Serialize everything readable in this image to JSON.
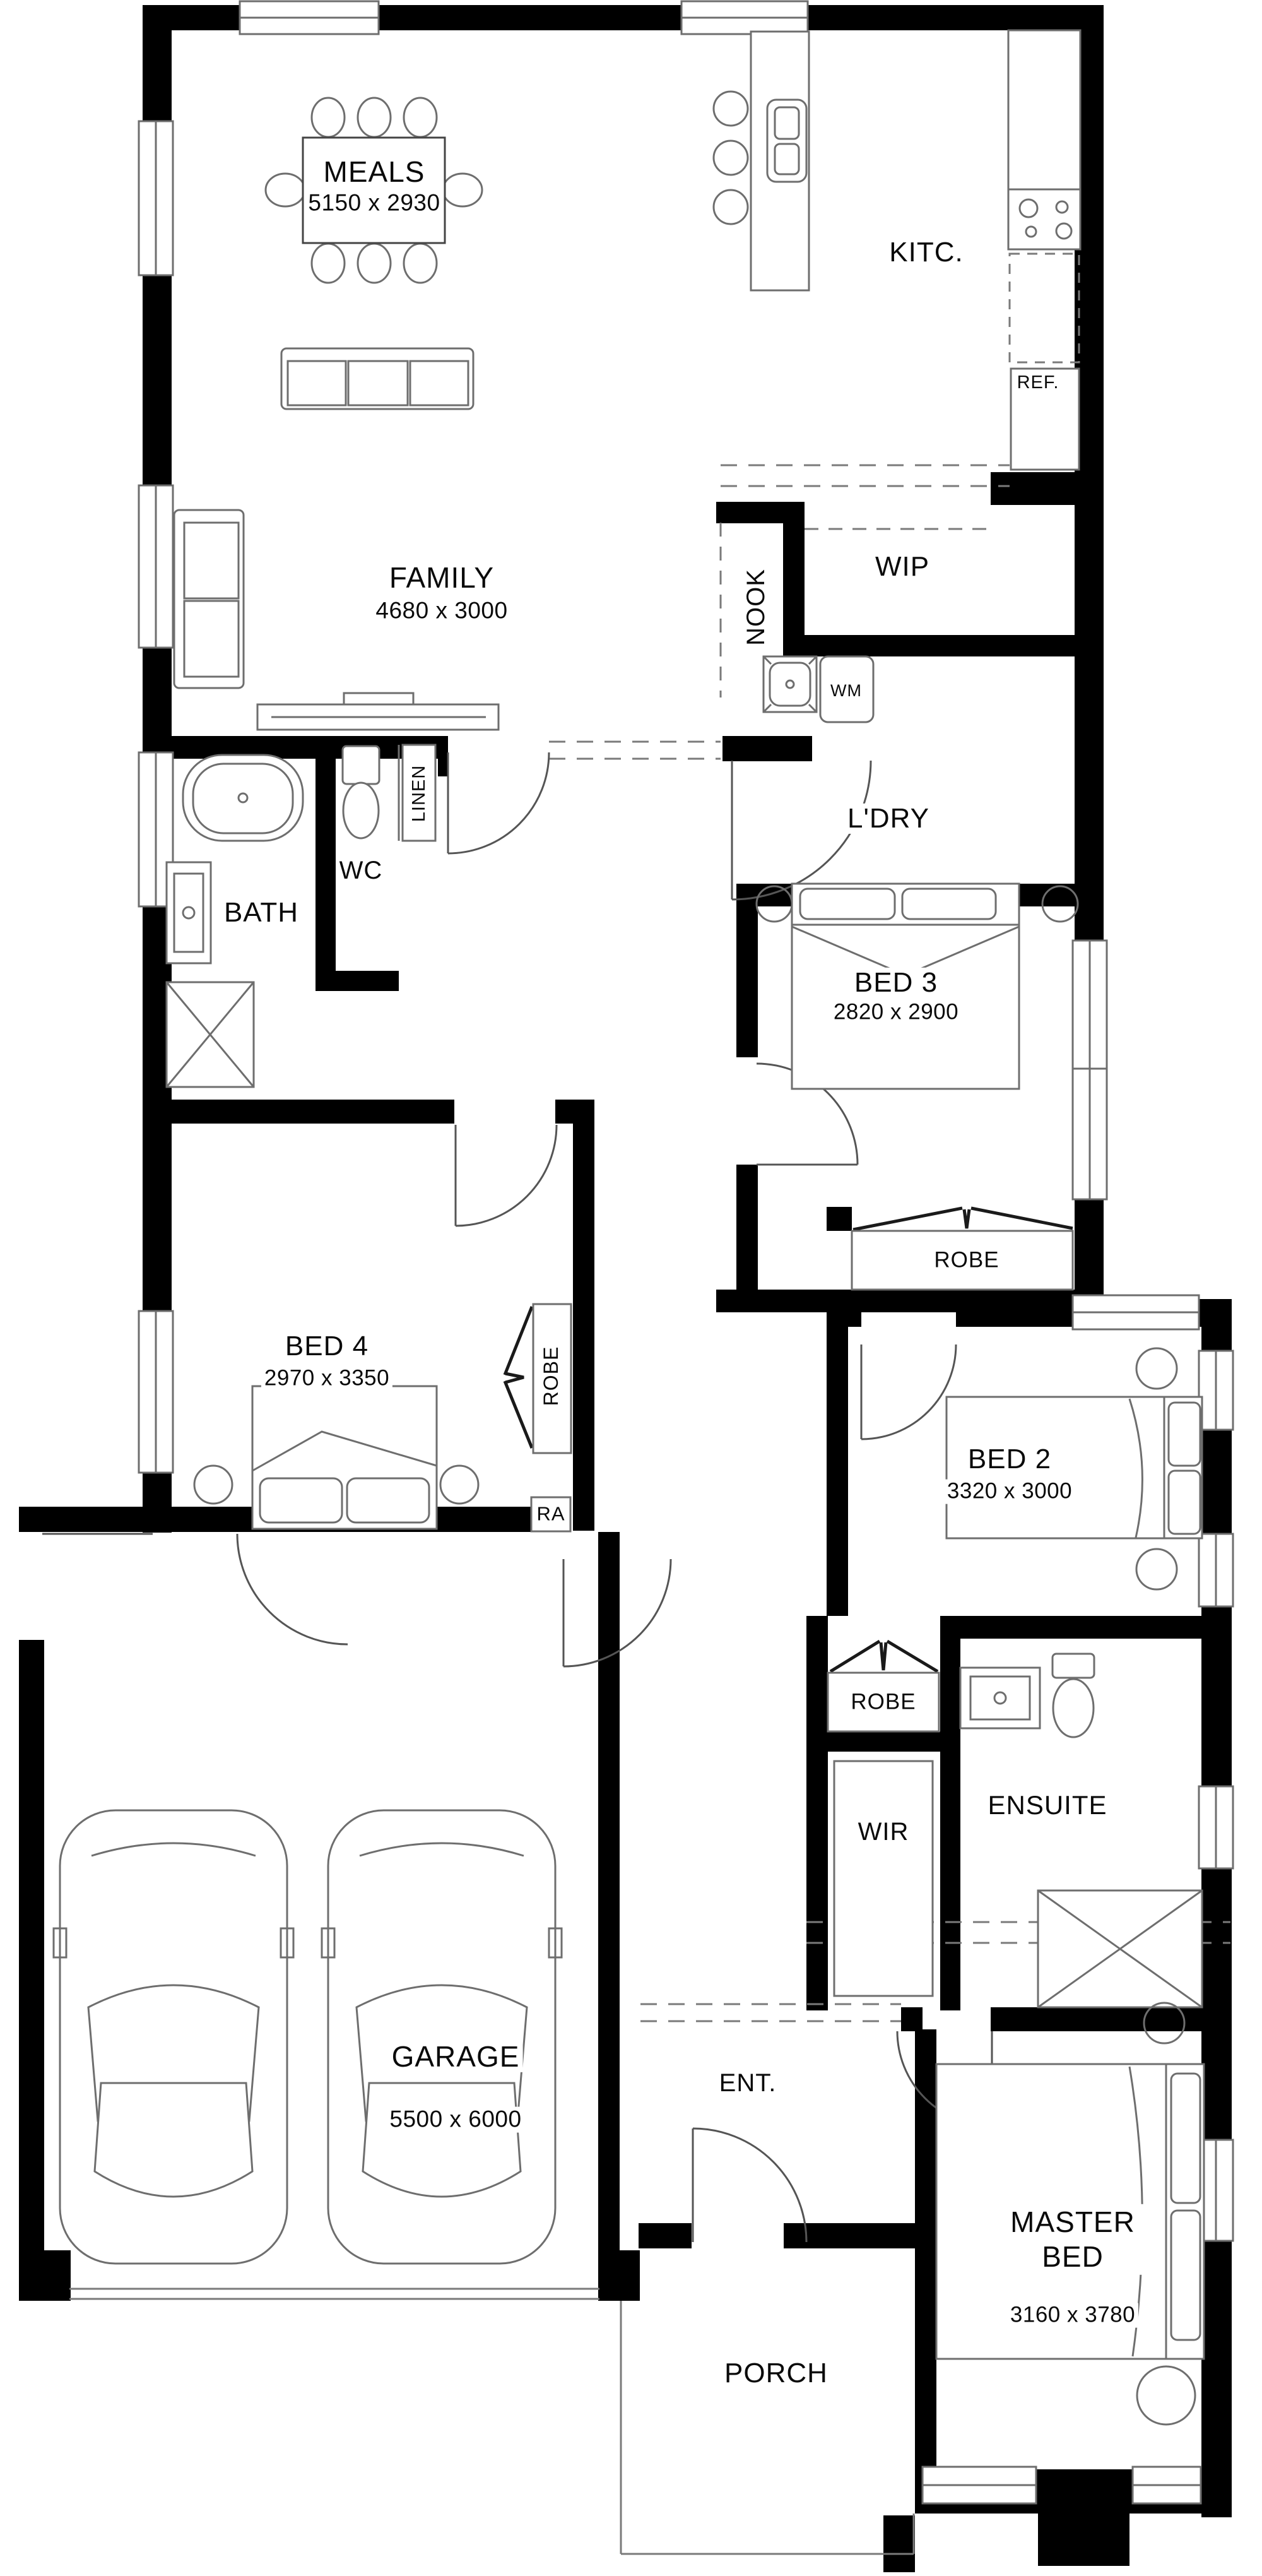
{
  "drawing_type": "residential floor plan",
  "colors": {
    "walls": "#000000",
    "lines": "#6e6e6e",
    "background": "#ffffff",
    "text": "#0a0a0a"
  },
  "rooms": {
    "meals": {
      "name": "MEALS",
      "dims": "5150 x 2930"
    },
    "kitchen": {
      "name": "KITC."
    },
    "ref": {
      "name": "REF."
    },
    "family": {
      "name": "FAMILY",
      "dims": "4680 x 3000"
    },
    "nook": {
      "name": "NOOK"
    },
    "wip": {
      "name": "WIP"
    },
    "laundry": {
      "name": "L'DRY"
    },
    "wm": {
      "name": "WM"
    },
    "linen": {
      "name": "LINEN"
    },
    "wc": {
      "name": "WC"
    },
    "bath": {
      "name": "BATH"
    },
    "bed3": {
      "name": "BED 3",
      "dims": "2820 x 2900"
    },
    "robe_bed3": {
      "name": "ROBE"
    },
    "bed4": {
      "name": "BED 4",
      "dims": "2970 x 3350"
    },
    "robe_bed4": {
      "name": "ROBE"
    },
    "ra": {
      "name": "RA"
    },
    "bed2": {
      "name": "BED 2",
      "dims": "3320 x 3000"
    },
    "robe_bed2": {
      "name": "ROBE"
    },
    "wir": {
      "name": "WIR"
    },
    "ensuite": {
      "name": "ENSUITE"
    },
    "garage": {
      "name": "GARAGE",
      "dims": "5500 x 6000"
    },
    "entry": {
      "name": "ENT."
    },
    "master": {
      "name": "MASTER BED",
      "dims": "3160 x 3780"
    },
    "porch": {
      "name": "PORCH"
    }
  }
}
